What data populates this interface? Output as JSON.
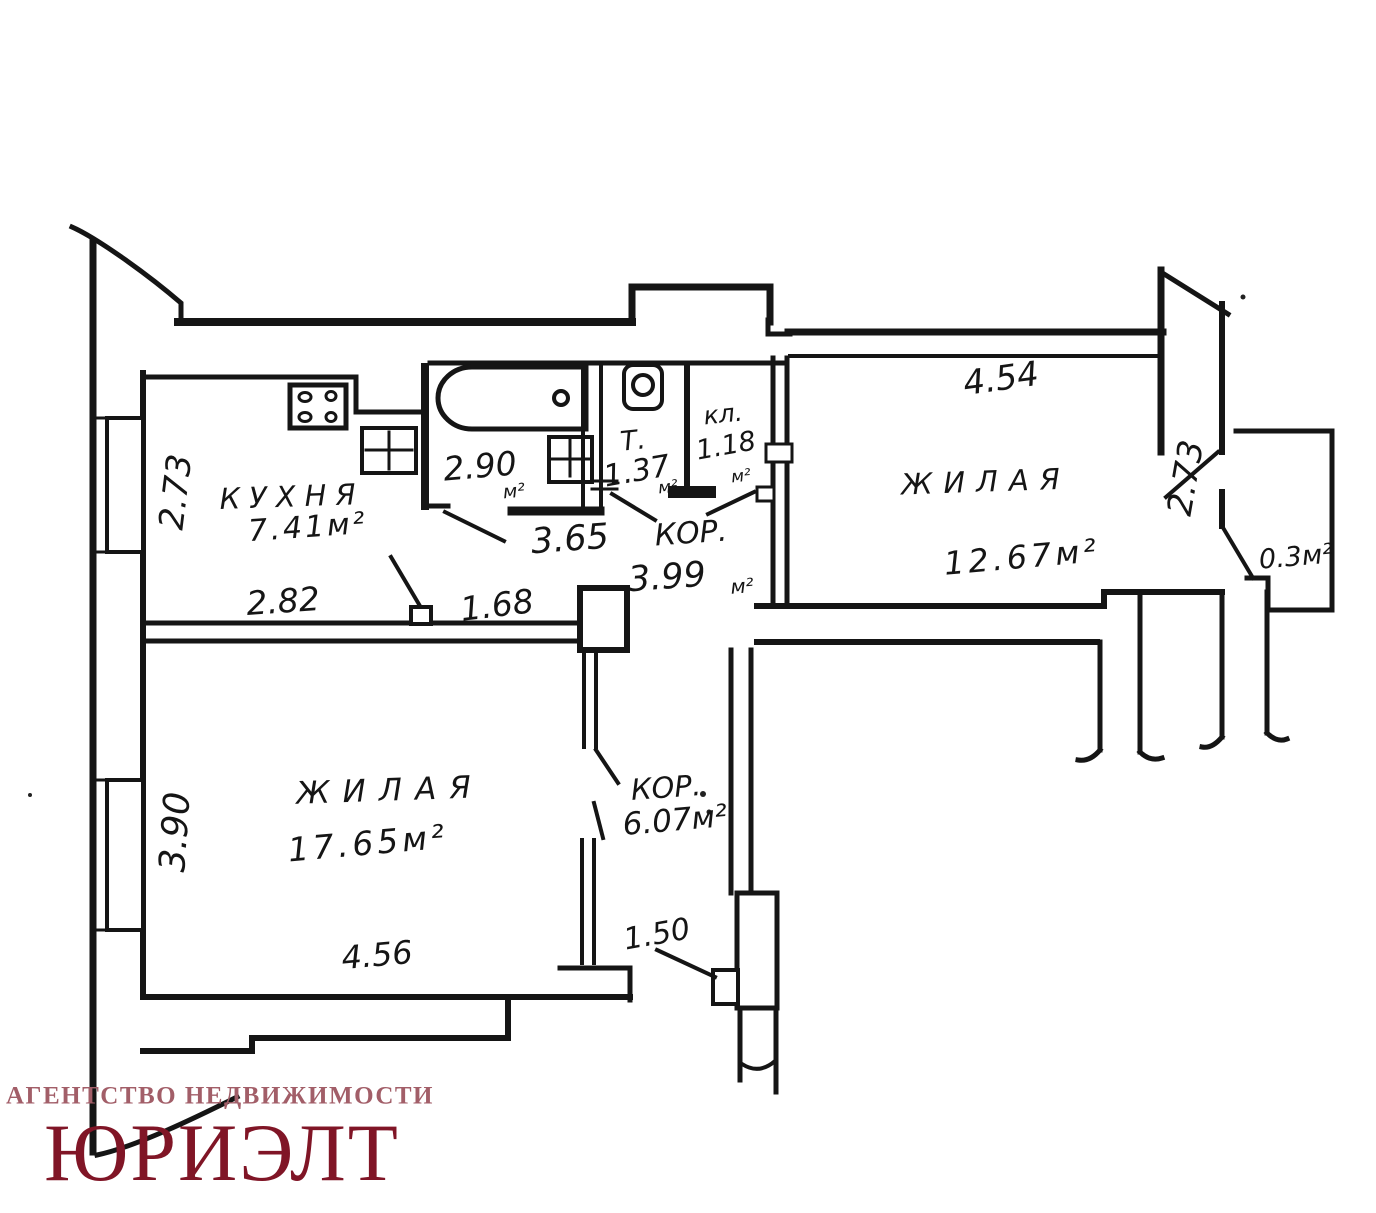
{
  "plan": {
    "rooms": {
      "kitchen": {
        "name": "КУХНЯ",
        "area": "7.41м²"
      },
      "living_left": {
        "name": "ЖИЛАЯ",
        "area": "17.65м²"
      },
      "living_right": {
        "name": "ЖИЛАЯ",
        "area": "12.67м²"
      },
      "bath": {
        "value": "2.90",
        "unit": "м²"
      },
      "toilet": {
        "abbr": "Т.",
        "value": "1.37",
        "unit": "м²"
      },
      "closet": {
        "abbr": "кл.",
        "value": "1.18",
        "unit": "м²"
      },
      "hall_top": {
        "abbr": "КОР.",
        "value": "3.99",
        "unit": "м²"
      },
      "hall_bottom": {
        "abbr": "КОР.",
        "area": "6.07м²"
      },
      "balcony": {
        "area": "0.3м²"
      }
    },
    "dimensions": {
      "kitchen_left": "2.73",
      "kitchen_width": "2.82",
      "kitchen_right": "1.68",
      "bath_width": "3.65",
      "living_left_height": "3.90",
      "living_left_width": "4.56",
      "entry_width": "1.50",
      "living_right_width": "4.54",
      "living_right_height": "2.73"
    }
  },
  "logo": {
    "tagline": "АГЕНТСТВО НЕДВИЖИМОСТИ",
    "brand": "ЮРИЭЛТ",
    "tagline_color": "#a25e68",
    "brand_color": "#801526"
  },
  "colors": {
    "ink": "#151515",
    "background": "#ffffff"
  }
}
